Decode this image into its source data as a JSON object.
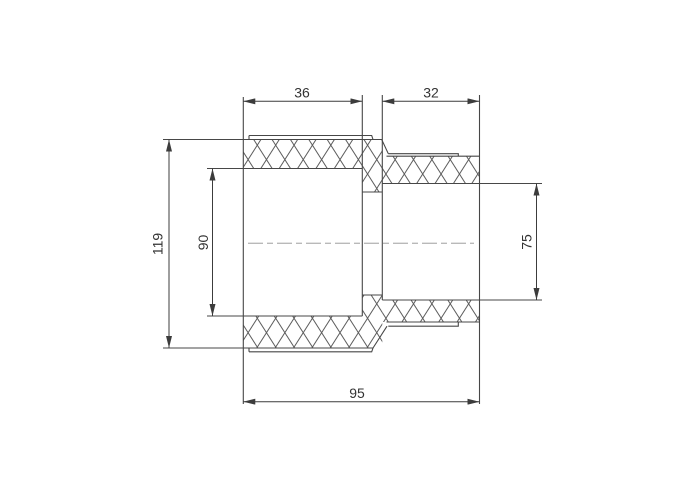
{
  "drawing": {
    "description": "Cross-section technical drawing of a reducing pipe coupling (socket fitting) with cross-hatched walls and a horizontal centerline",
    "view": "section",
    "dimension_labels": {
      "left_socket_depth": "36",
      "right_socket_depth": "32",
      "body_outer_diameter": "119",
      "left_bore_diameter": "90",
      "right_bore_diameter": "75",
      "overall_length": "95"
    },
    "colors": {
      "background": "#ffffff",
      "outline": "#474747",
      "dimension_line": "#3c3c3c",
      "hatch": "#5c5c5c",
      "centerline": "#b9b9b9",
      "text": "#333333"
    }
  }
}
